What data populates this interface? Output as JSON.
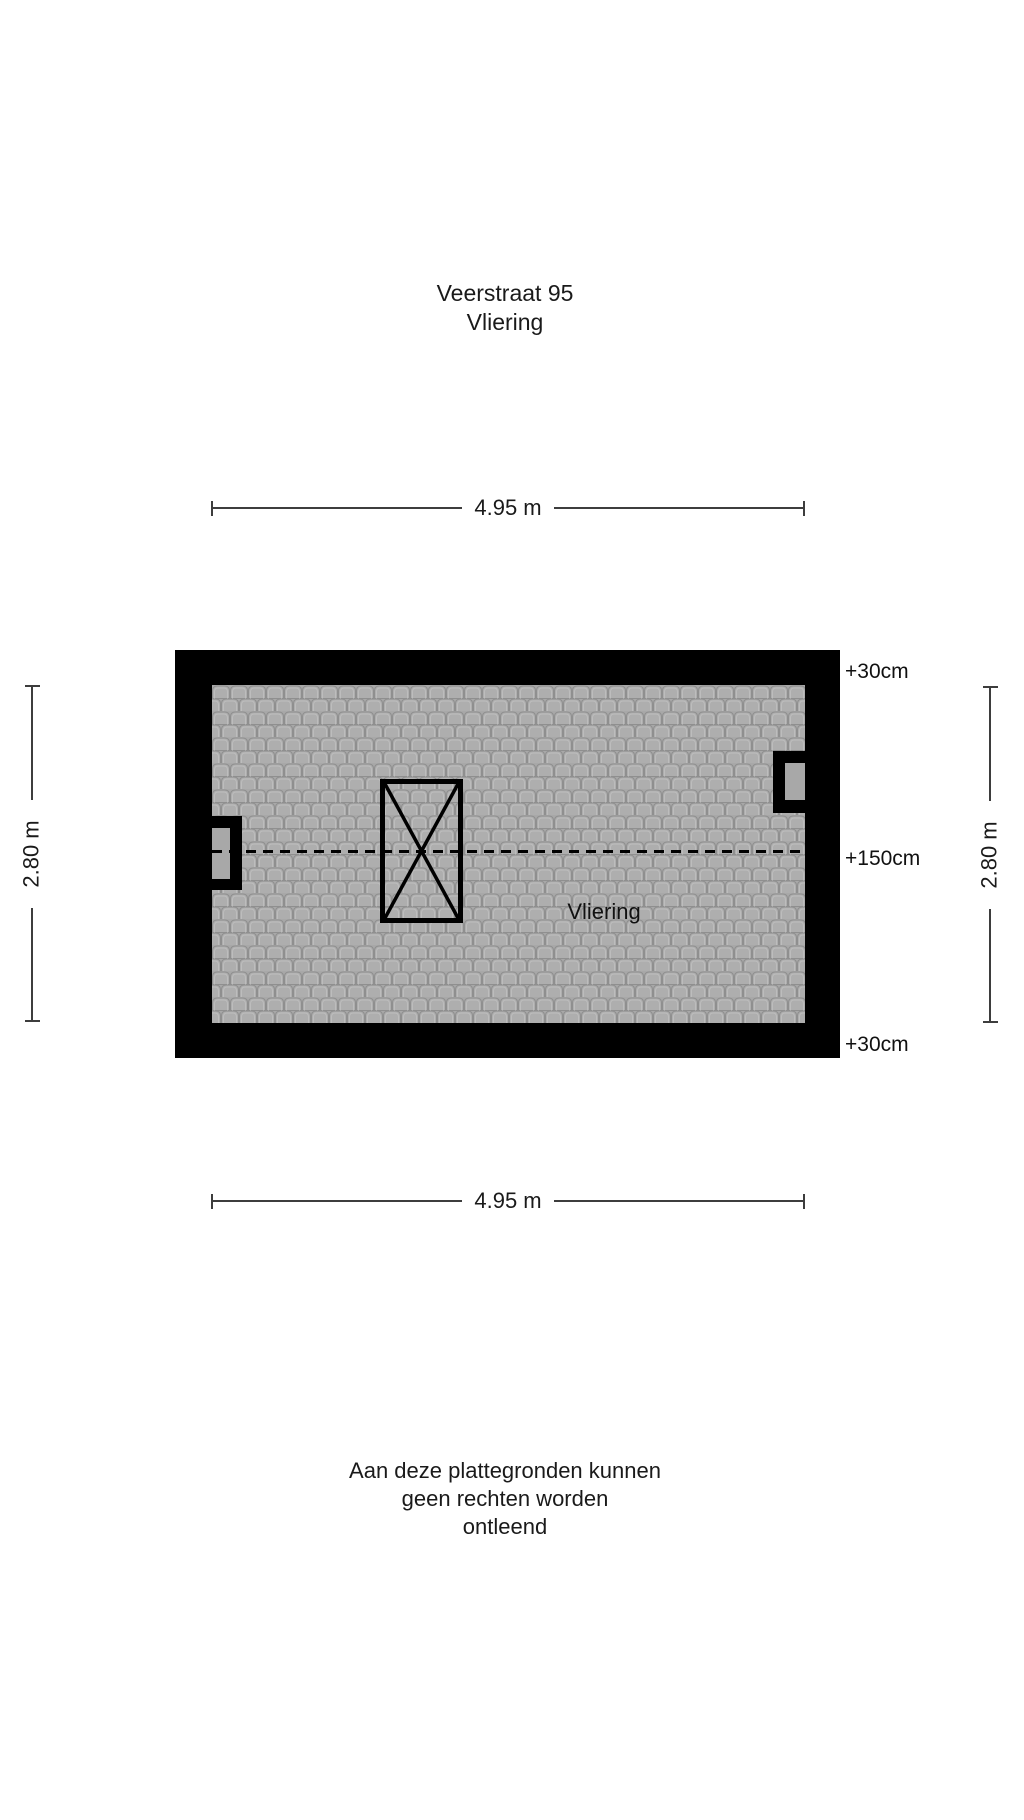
{
  "title": {
    "line1": "Veerstraat 95",
    "line2": "Vliering"
  },
  "floor_plan": {
    "room_label": "Vliering",
    "elevation_labels": {
      "top": "+30cm",
      "middle": "+150cm",
      "bottom": "+30cm"
    }
  },
  "dimensions": {
    "width_top": "4.95 m",
    "width_bottom": "4.95 m",
    "height_left": "2.80 m",
    "height_right": "2.80 m"
  },
  "disclaimer": {
    "line1": "Aan deze plattegronden kunnen",
    "line2": "geen rechten worden",
    "line3": "ontleend"
  },
  "colors": {
    "wall": "#000000",
    "tile_base": "#a8a8a8",
    "tile_fill": "#aeaeae",
    "tile_outline": "#8f8f8f",
    "tile_highlight": "#bdbdbd",
    "dimension_line": "#3d3d3d",
    "text": "#1a1a1a",
    "background": "#ffffff"
  }
}
